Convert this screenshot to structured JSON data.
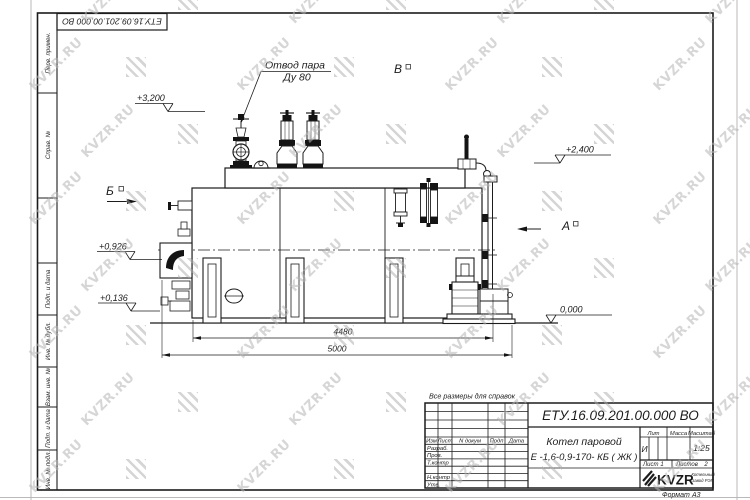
{
  "watermark": {
    "text": "KVZR.RU"
  },
  "corner_stamp": {
    "designation": "ЕТУ.16.09.201.00.000  ВО"
  },
  "margin": {
    "perv_primen": "Перв. примен.",
    "sprav_no": "Справ. №",
    "podp_data_1": "Подп. и дата",
    "inv_dubl": "Инв. № дубл.",
    "vzam_inv": "Взам. инв. №",
    "podp_data_2": "Подп. и дата",
    "inv_podl": "Инв. № подл."
  },
  "drawing": {
    "leader": {
      "line1": "Отвод пара",
      "line2": "Ду 80"
    },
    "elevations": {
      "e3200": "+3,200",
      "e2400": "+2,400",
      "e0926": "+0,926",
      "e0136": "+0,136",
      "e0000": "0,000"
    },
    "views": {
      "b": "Б",
      "v": "В",
      "a": "А"
    },
    "dims": {
      "d4480": "4480",
      "d5000": "5000"
    }
  },
  "note": "Все размеры для справок",
  "title_block": {
    "designation": "ЕТУ.16.09.201.00.000  ВО",
    "name_line1": "Котел паровой",
    "name_line2": "Е -1,6-0,9-170- КБ ( ЖК )",
    "header": {
      "izm": "Изм",
      "list": "Лист",
      "ndokum": "N докум",
      "podp": "Подп",
      "data": "Дата"
    },
    "rows": {
      "razrab": "Разраб.",
      "prov": "Пров.",
      "tkontr": "Т.контр",
      "nkontr": "Н.контр",
      "utv": "Утв."
    },
    "lit_label": "Лит",
    "massa_label": "Масса",
    "masshtab_label": "Масштаб",
    "lit_value": "И",
    "masshtab_value": "1:25",
    "list_label": "Лист",
    "list_value": "1",
    "listov_label": "Листов",
    "listov_value": "2",
    "logo_text": "KVZR",
    "logo_sub1": "Котельный",
    "logo_sub2": "завод РЭП",
    "format_label": "Формат",
    "format_value": "А3"
  }
}
